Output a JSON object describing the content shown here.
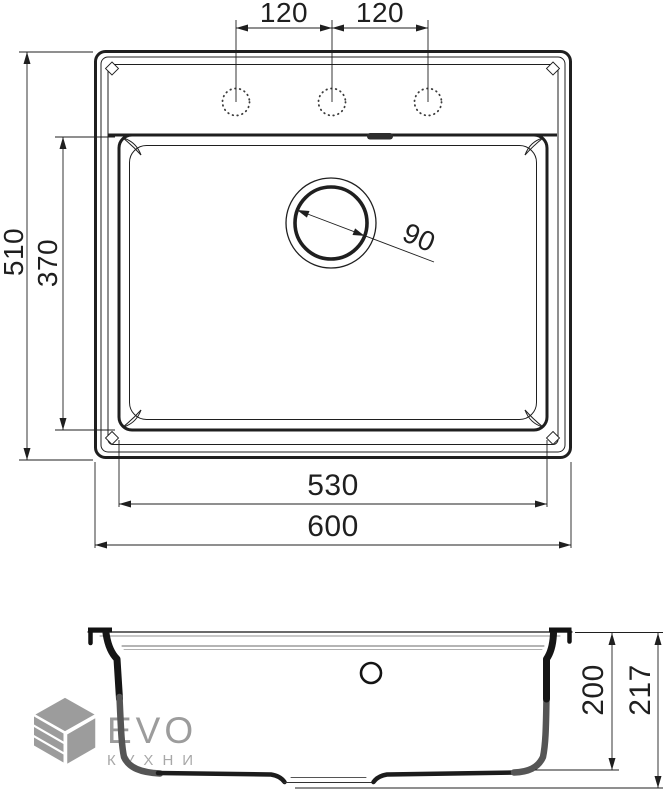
{
  "colors": {
    "line": "#1f1f1f",
    "logo_gray": "#9c9c9c",
    "background": "#ffffff"
  },
  "logo": {
    "brand": "EVO",
    "tagline": "КУХНИ"
  },
  "top_view": {
    "faucet_spacing_left": "120",
    "faucet_spacing_right": "120",
    "overall_depth": "510",
    "bowl_depth": "370",
    "drain_diameter": "90",
    "bowl_width": "530",
    "overall_width": "600"
  },
  "side_view": {
    "bowl_height": "200",
    "overall_height": "217"
  }
}
